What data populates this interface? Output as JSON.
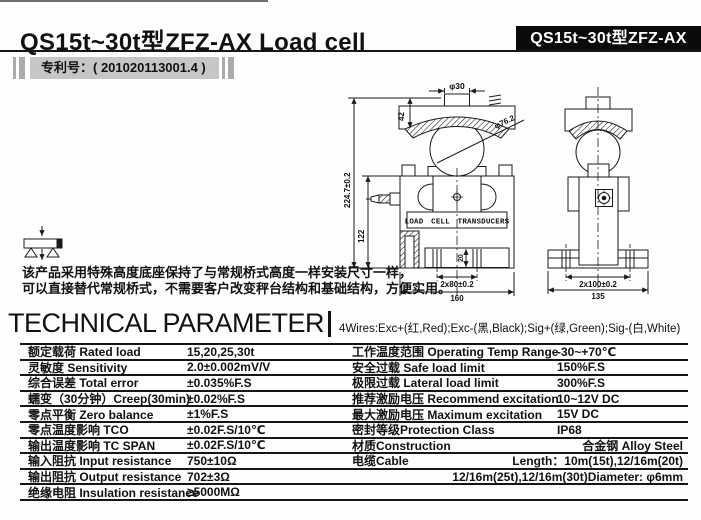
{
  "header": {
    "title": "QS15t~30t型ZFZ-AX  Load cell",
    "model_badge": "QS15t~30t型ZFZ-AX",
    "patent_label": "专利号：( 201020113001.4 )"
  },
  "description": {
    "line1": "该产品采用特殊高度底座保持了与常规桥式高度一样安装尺寸一样，",
    "line2": "可以直接替代常规桥式，不需要客户改变秤台结构和基础结构，方便实用。"
  },
  "drawing": {
    "front_view": {
      "plate_label": "LOAD CELL TRANSDUCERS",
      "dims": {
        "button_diameter": "φ30",
        "plate_height": "42",
        "ball_diameter": "φ76.2",
        "total_height": "224.7±0.2",
        "body_height": "122",
        "bolt_depth": "20",
        "bolt_spacing": "2x80±0.2",
        "base_width": "160"
      }
    },
    "side_view": {
      "dims": {
        "bolt_spacing": "2x100±0.2",
        "base_width": "135"
      }
    }
  },
  "parameters": {
    "heading": "TECHNICAL PARAMETER",
    "wiring": "4Wires:Exc+(红,Red);Exc-(黑,Black);Sig+(绿,Green);Sig-(白,White)",
    "left_rows": [
      {
        "label": "额定载荷 Rated load",
        "value": "15,20,25,30t"
      },
      {
        "label": "灵敏度 Sensitivity",
        "value": "2.0±0.002mV/V"
      },
      {
        "label": "综合误差 Total error",
        "value": "±0.035%F.S"
      },
      {
        "label": "蠕变（30分钟）Creep(30min)",
        "value": "±0.02%F.S"
      },
      {
        "label": "零点平衡 Zero balance",
        "value": "±1%F.S"
      },
      {
        "label": "零点温度影响 TCO",
        "value": "±0.02F.S/10℃"
      },
      {
        "label": "输出温度影响 TC SPAN",
        "value": "±0.02F.S/10℃"
      },
      {
        "label": "输入阻抗 Input resistance",
        "value": "750±10Ω"
      },
      {
        "label": "输出阻抗 Output resistance",
        "value": "702±3Ω"
      },
      {
        "label": "绝缘电阻 Insulation resistance",
        "value": "≥5000MΩ"
      }
    ],
    "right_rows": [
      {
        "label": "工作温度范围 Operating Temp Range",
        "value": "-30~+70℃"
      },
      {
        "label": "安全过载 Safe load limit",
        "value": "150%F.S"
      },
      {
        "label": "极限过载 Lateral load limit",
        "value": "300%F.S"
      },
      {
        "label": "推荐激励电压 Recommend excitation",
        "value": "10~12V DC"
      },
      {
        "label": "最大激励电压 Maximum excitation",
        "value": "15V DC"
      },
      {
        "label": "密封等级Protection Class",
        "value": "IP68"
      },
      {
        "label": "材质Construction",
        "value": "合金钢  Alloy Steel"
      },
      {
        "label": "电缆Cable",
        "value": "Length：10m(15t),12/16m(20t)"
      },
      {
        "label": "",
        "value": "12/16m(25t),12/16m(30t)Diameter: φ6mm"
      },
      {
        "label": "",
        "value": ""
      }
    ]
  },
  "colors": {
    "ink": "#111111",
    "badge_bg": "#0b0b0b",
    "patent_bg": "#c6c6c6"
  }
}
